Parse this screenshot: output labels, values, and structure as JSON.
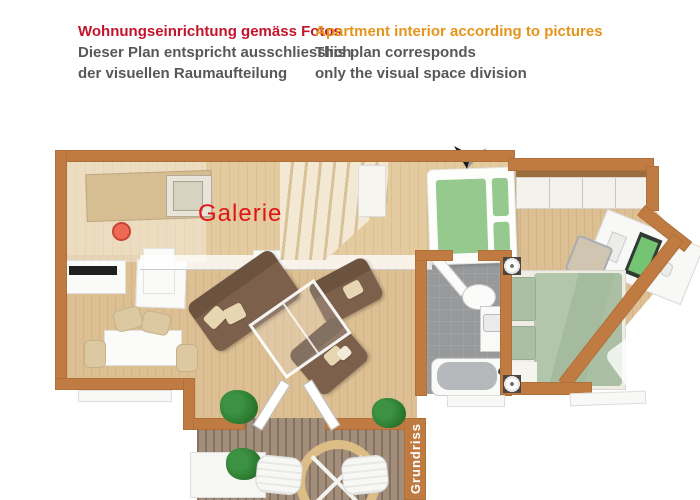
{
  "header": {
    "german": {
      "title": "Wohnungseinrichtung gemäss Fotos",
      "line1": "Dieser Plan entspricht ausschliesslich",
      "line2": "der visuellen Raumaufteilung"
    },
    "english": {
      "title": "Apartment interior according to pictures",
      "line1": "This plan corresponds",
      "line2": "only the visual space division"
    }
  },
  "floorplan": {
    "galerie_label": "Galerie",
    "grundriss_label": "Grundriss"
  },
  "colors": {
    "german_title": "#c3142b",
    "english_title": "#e5941c",
    "subtitle_text": "#58585a",
    "wall": "#bf7b41",
    "wood_floor": "#dcbf92",
    "galerie_floor": "#e3cb9f",
    "deck": "#9d8874",
    "bathroom_floor": "#97999b",
    "sofa": "#7d604b",
    "cushion": "#e7d6b2",
    "bed_green": "#95c98d",
    "bed_sage": "#aabfa3",
    "plant": "#2e7d32",
    "galerie_label_color": "#e01616",
    "monitor_screen": "#74c473",
    "table_ring": "#dbbd85"
  }
}
